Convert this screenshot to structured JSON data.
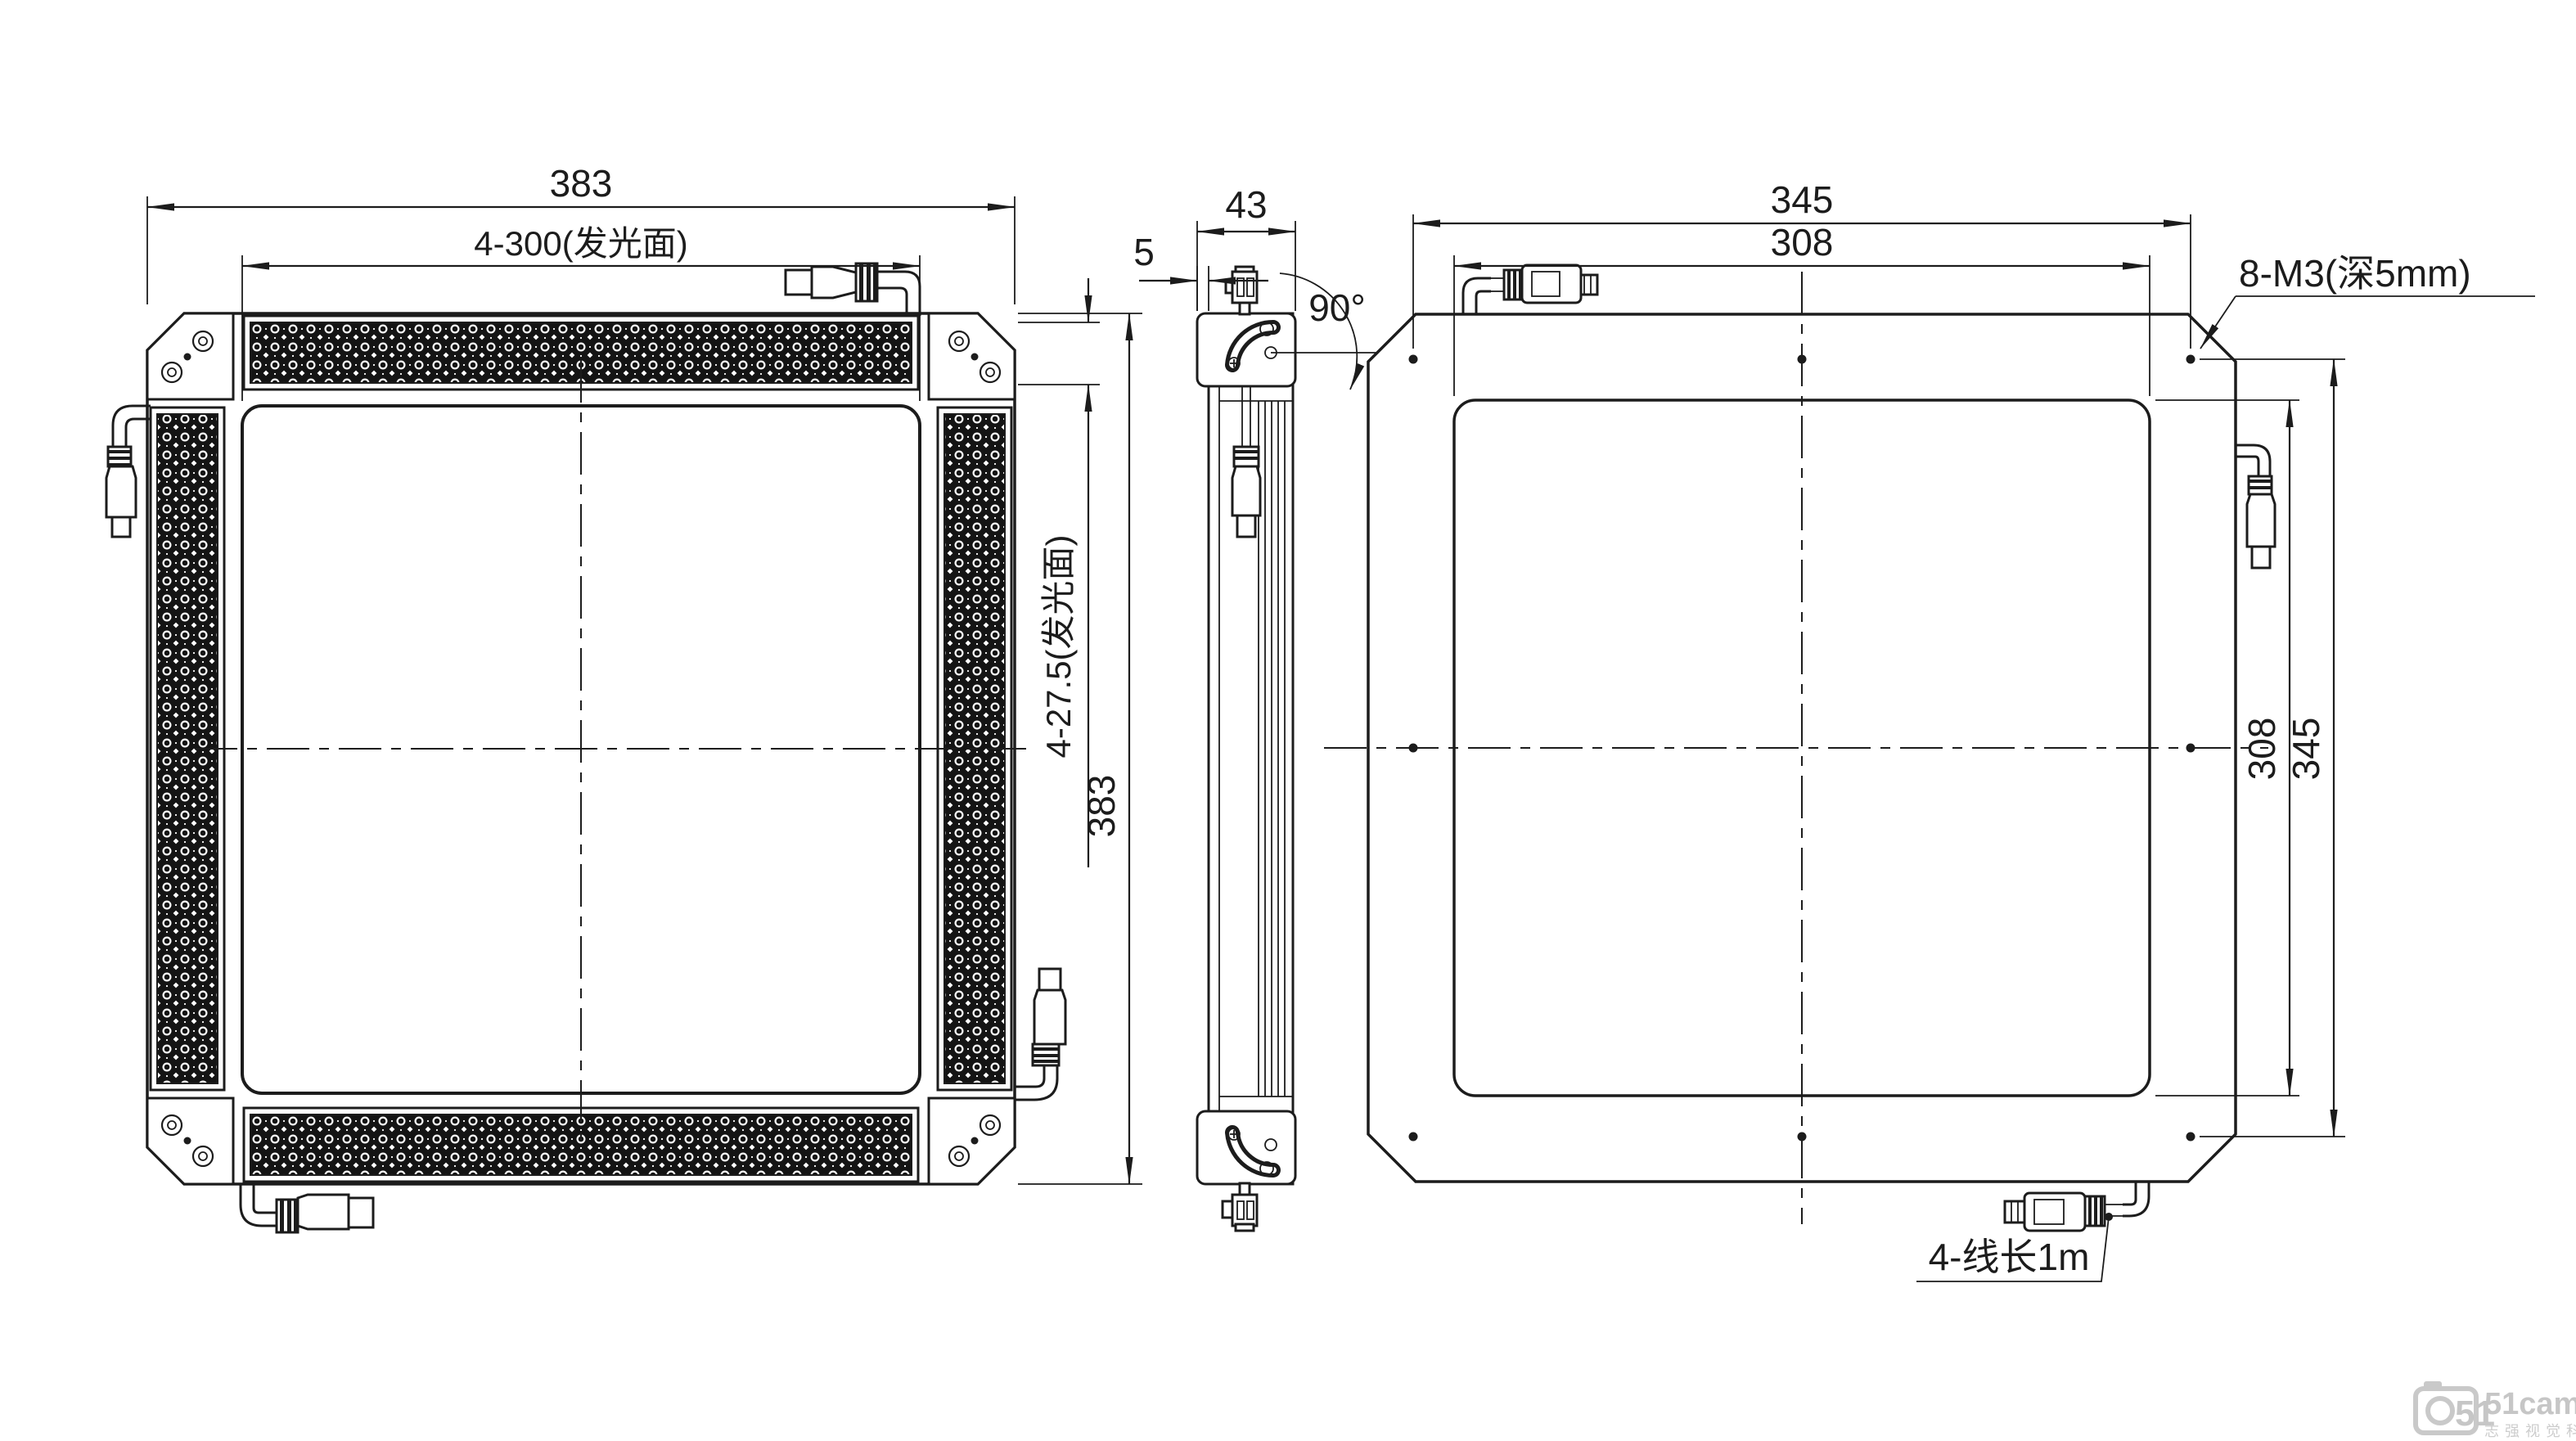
{
  "front": {
    "dim_width_top": "383",
    "dim_light_width": "4-300(发光面)",
    "dim_bar_width": "4-27.5(发光面)",
    "dim_height": "383"
  },
  "side": {
    "dim_depth": "43",
    "dim_face_offset": "5",
    "dim_rotation": "90°"
  },
  "back": {
    "dim_width_outer": "345",
    "dim_width_inner": "308",
    "dim_height_inner": "308",
    "dim_height_outer": "345",
    "label_screw_holes": "8-M3(深5mm)",
    "label_cable_length": "4-线长1m"
  },
  "watermark": {
    "brand": "51camera",
    "tagline": "志强视觉科技",
    "logo": "51"
  }
}
